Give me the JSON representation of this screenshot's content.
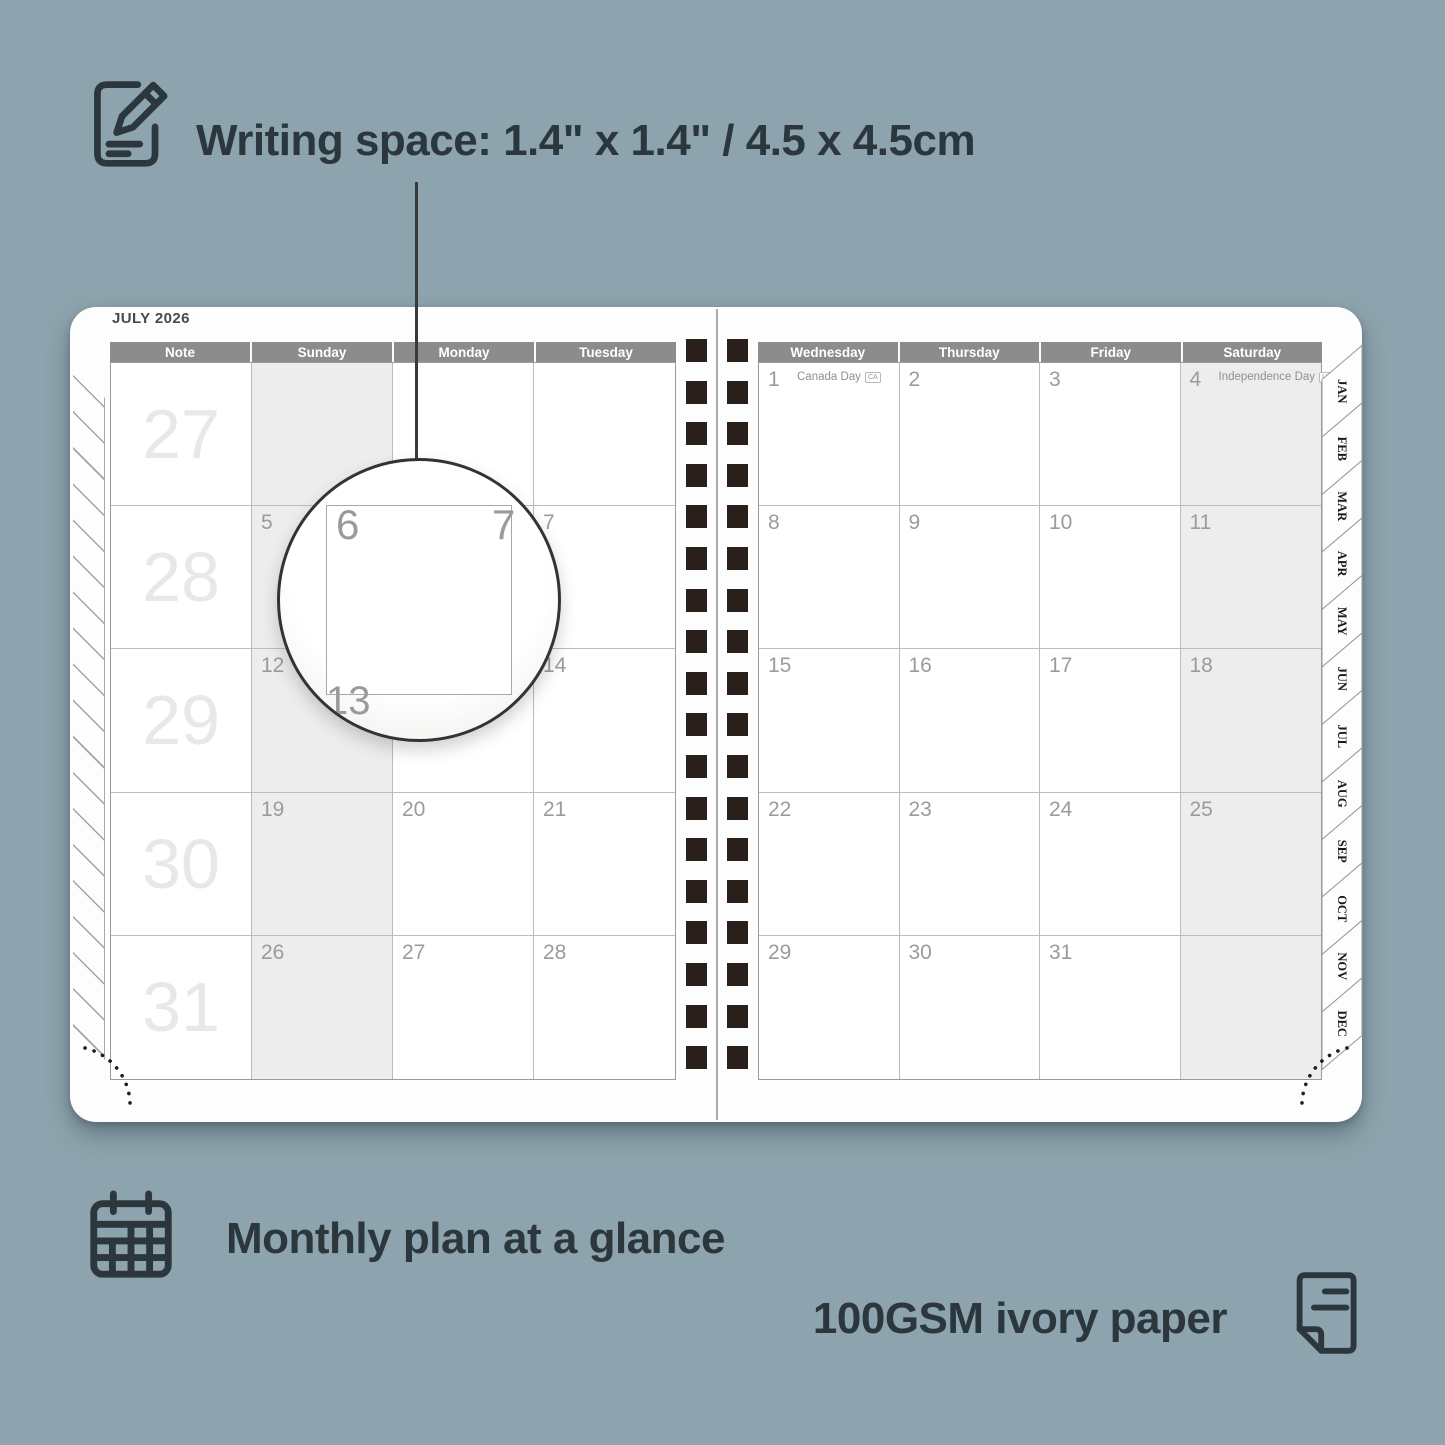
{
  "annotations": {
    "writing_space": "Writing space: 1.4\" x 1.4\" / 4.5 x 4.5cm",
    "monthly_plan": "Monthly plan at a glance",
    "paper": "100GSM ivory paper"
  },
  "calendar": {
    "title": "JULY 2026",
    "left_headers": [
      "Note",
      "Sunday",
      "Monday",
      "Tuesday"
    ],
    "right_headers": [
      "Wednesday",
      "Thursday",
      "Friday",
      "Saturday"
    ],
    "week_numbers": [
      "27",
      "28",
      "29",
      "30",
      "31"
    ],
    "left_days": [
      [
        "",
        "",
        ""
      ],
      [
        "5",
        "6",
        "7"
      ],
      [
        "12",
        "13",
        "14"
      ],
      [
        "19",
        "20",
        "21"
      ],
      [
        "26",
        "27",
        "28"
      ]
    ],
    "right_days": [
      [
        "1",
        "2",
        "3",
        "4"
      ],
      [
        "8",
        "9",
        "10",
        "11"
      ],
      [
        "15",
        "16",
        "17",
        "18"
      ],
      [
        "22",
        "23",
        "24",
        "25"
      ],
      [
        "29",
        "30",
        "31",
        ""
      ]
    ],
    "holidays": [
      {
        "day": "1",
        "label": "Canada Day",
        "badge": "CA"
      },
      {
        "day": "4",
        "label": "Independence Day",
        "badge": "US"
      }
    ],
    "tabs": [
      "JAN",
      "FEB",
      "MAR",
      "APR",
      "MAY",
      "JUN",
      "JUL",
      "AUG",
      "SEP",
      "OCT",
      "NOV",
      "DEC"
    ],
    "magnifier": {
      "day": "6",
      "adjacent_day": "7",
      "below_day": "13"
    }
  },
  "colors": {
    "background": "#8da4ae",
    "ink": "#2b373d",
    "header_bg": "#8c8c8c",
    "header_text": "#ffffff",
    "day_number": "#9b9b9b",
    "week_number": "#e8e8e8",
    "weekend_shade": "#ededed",
    "spiral": "#29201b"
  }
}
